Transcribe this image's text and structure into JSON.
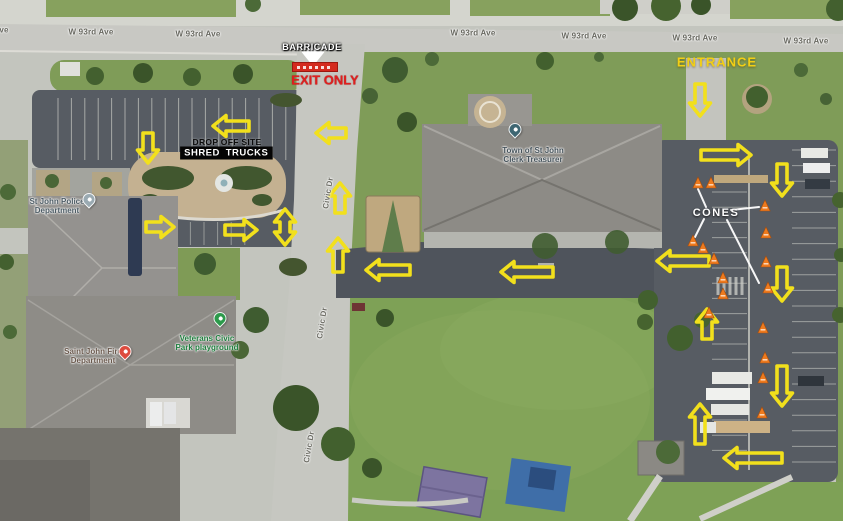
{
  "streets": {
    "w93rd_labels": [
      {
        "text": "ve",
        "x": 4,
        "y": 30
      },
      {
        "text": "W 93rd Ave",
        "x": 91,
        "y": 32
      },
      {
        "text": "W 93rd Ave",
        "x": 198,
        "y": 34
      },
      {
        "text": "W 93rd Ave",
        "x": 473,
        "y": 33
      },
      {
        "text": "W 93rd Ave",
        "x": 584,
        "y": 36
      },
      {
        "text": "W 93rd Ave",
        "x": 695,
        "y": 38
      },
      {
        "text": "W 93rd Ave",
        "x": 806,
        "y": 41
      }
    ],
    "civic_labels": [
      {
        "text": "Civic Dr",
        "x": 328,
        "y": 193,
        "rotate": -81
      },
      {
        "text": "Civic Dr",
        "x": 322,
        "y": 323,
        "rotate": -81
      },
      {
        "text": "Civic Dr",
        "x": 309,
        "y": 447,
        "rotate": -80
      }
    ]
  },
  "pois": [
    {
      "id": "town-clerk",
      "lines": [
        "Town of St John",
        "Clerk-Treasurer"
      ],
      "label_x": 533,
      "label_y": 155,
      "pin_x": 515,
      "pin_y": 136,
      "pin_color": "#3e6672",
      "text_color": "#47545c"
    },
    {
      "id": "police",
      "lines": [
        "St John Police",
        "Department"
      ],
      "label_x": 57,
      "label_y": 206,
      "pin_x": 89,
      "pin_y": 206,
      "pin_color": "#9aaab2",
      "text_color": "#4e5d66"
    },
    {
      "id": "fire",
      "lines": [
        "Saint John Fire",
        "Department"
      ],
      "label_x": 93,
      "label_y": 356,
      "pin_x": 125,
      "pin_y": 358,
      "pin_color": "#dd4b3e",
      "text_color": "#6a594d"
    },
    {
      "id": "park",
      "lines": [
        "Veterans Civic",
        "Park playground"
      ],
      "label_x": 207,
      "label_y": 343,
      "pin_x": 220,
      "pin_y": 325,
      "pin_color": "#2c9a4b",
      "text_color": "#1e7e3e"
    }
  ],
  "callouts": {
    "barricade": "BARRICADE",
    "exit_only": "EXIT ONLY",
    "drop_off_site": "DROP OFF SITE",
    "shred": "SHRED",
    "trucks": "TRUCKS",
    "entrance": "ENTRANCE",
    "cones": "CONES"
  },
  "colors": {
    "arrow_yellow": "#f2e01c",
    "cone_orange": "#ee7a1d",
    "barricade_red": "#d42a1e",
    "exit_red": "#e01f1f",
    "entrance_yellow": "#f2cf15"
  },
  "arrows": [
    {
      "x": 231,
      "y": 126,
      "dir": "left",
      "len": 36
    },
    {
      "x": 148,
      "y": 148,
      "dir": "down",
      "len": 30
    },
    {
      "x": 160,
      "y": 227,
      "dir": "right",
      "len": 28
    },
    {
      "x": 241,
      "y": 230,
      "dir": "right",
      "len": 32
    },
    {
      "x": 285,
      "y": 227,
      "dir": "updown",
      "len": 36
    },
    {
      "x": 331,
      "y": 133,
      "dir": "left",
      "len": 30
    },
    {
      "x": 340,
      "y": 198,
      "dir": "up",
      "len": 30
    },
    {
      "x": 338,
      "y": 255,
      "dir": "up",
      "len": 34
    },
    {
      "x": 388,
      "y": 270,
      "dir": "left",
      "len": 44
    },
    {
      "x": 527,
      "y": 272,
      "dir": "left",
      "len": 52
    },
    {
      "x": 700,
      "y": 100,
      "dir": "down",
      "len": 32
    },
    {
      "x": 726,
      "y": 155,
      "dir": "right",
      "len": 50
    },
    {
      "x": 782,
      "y": 180,
      "dir": "down",
      "len": 32
    },
    {
      "x": 683,
      "y": 261,
      "dir": "left",
      "len": 52
    },
    {
      "x": 782,
      "y": 284,
      "dir": "down",
      "len": 34
    },
    {
      "x": 707,
      "y": 324,
      "dir": "up",
      "len": 30
    },
    {
      "x": 782,
      "y": 386,
      "dir": "down",
      "len": 40
    },
    {
      "x": 700,
      "y": 424,
      "dir": "up",
      "len": 40
    },
    {
      "x": 753,
      "y": 458,
      "dir": "left",
      "len": 58
    }
  ],
  "barricade_pointer": {
    "x": 313,
    "y": 57,
    "dir": "down",
    "len": 16
  },
  "cones": [
    [
      698,
      183
    ],
    [
      711,
      183
    ],
    [
      765,
      206
    ],
    [
      766,
      233
    ],
    [
      693,
      241
    ],
    [
      703,
      248
    ],
    [
      714,
      259
    ],
    [
      766,
      262
    ],
    [
      723,
      278
    ],
    [
      723,
      294
    ],
    [
      768,
      288
    ],
    [
      709,
      313
    ],
    [
      763,
      328
    ],
    [
      765,
      358
    ],
    [
      763,
      378
    ],
    [
      762,
      413
    ]
  ],
  "cone_lines": [
    {
      "x1": 706,
      "y1": 207,
      "x2": 698,
      "y2": 189
    },
    {
      "x1": 704,
      "y1": 219,
      "x2": 695,
      "y2": 237
    },
    {
      "x1": 731,
      "y1": 210,
      "x2": 759,
      "y2": 207
    },
    {
      "x1": 727,
      "y1": 220,
      "x2": 759,
      "y2": 283
    }
  ]
}
